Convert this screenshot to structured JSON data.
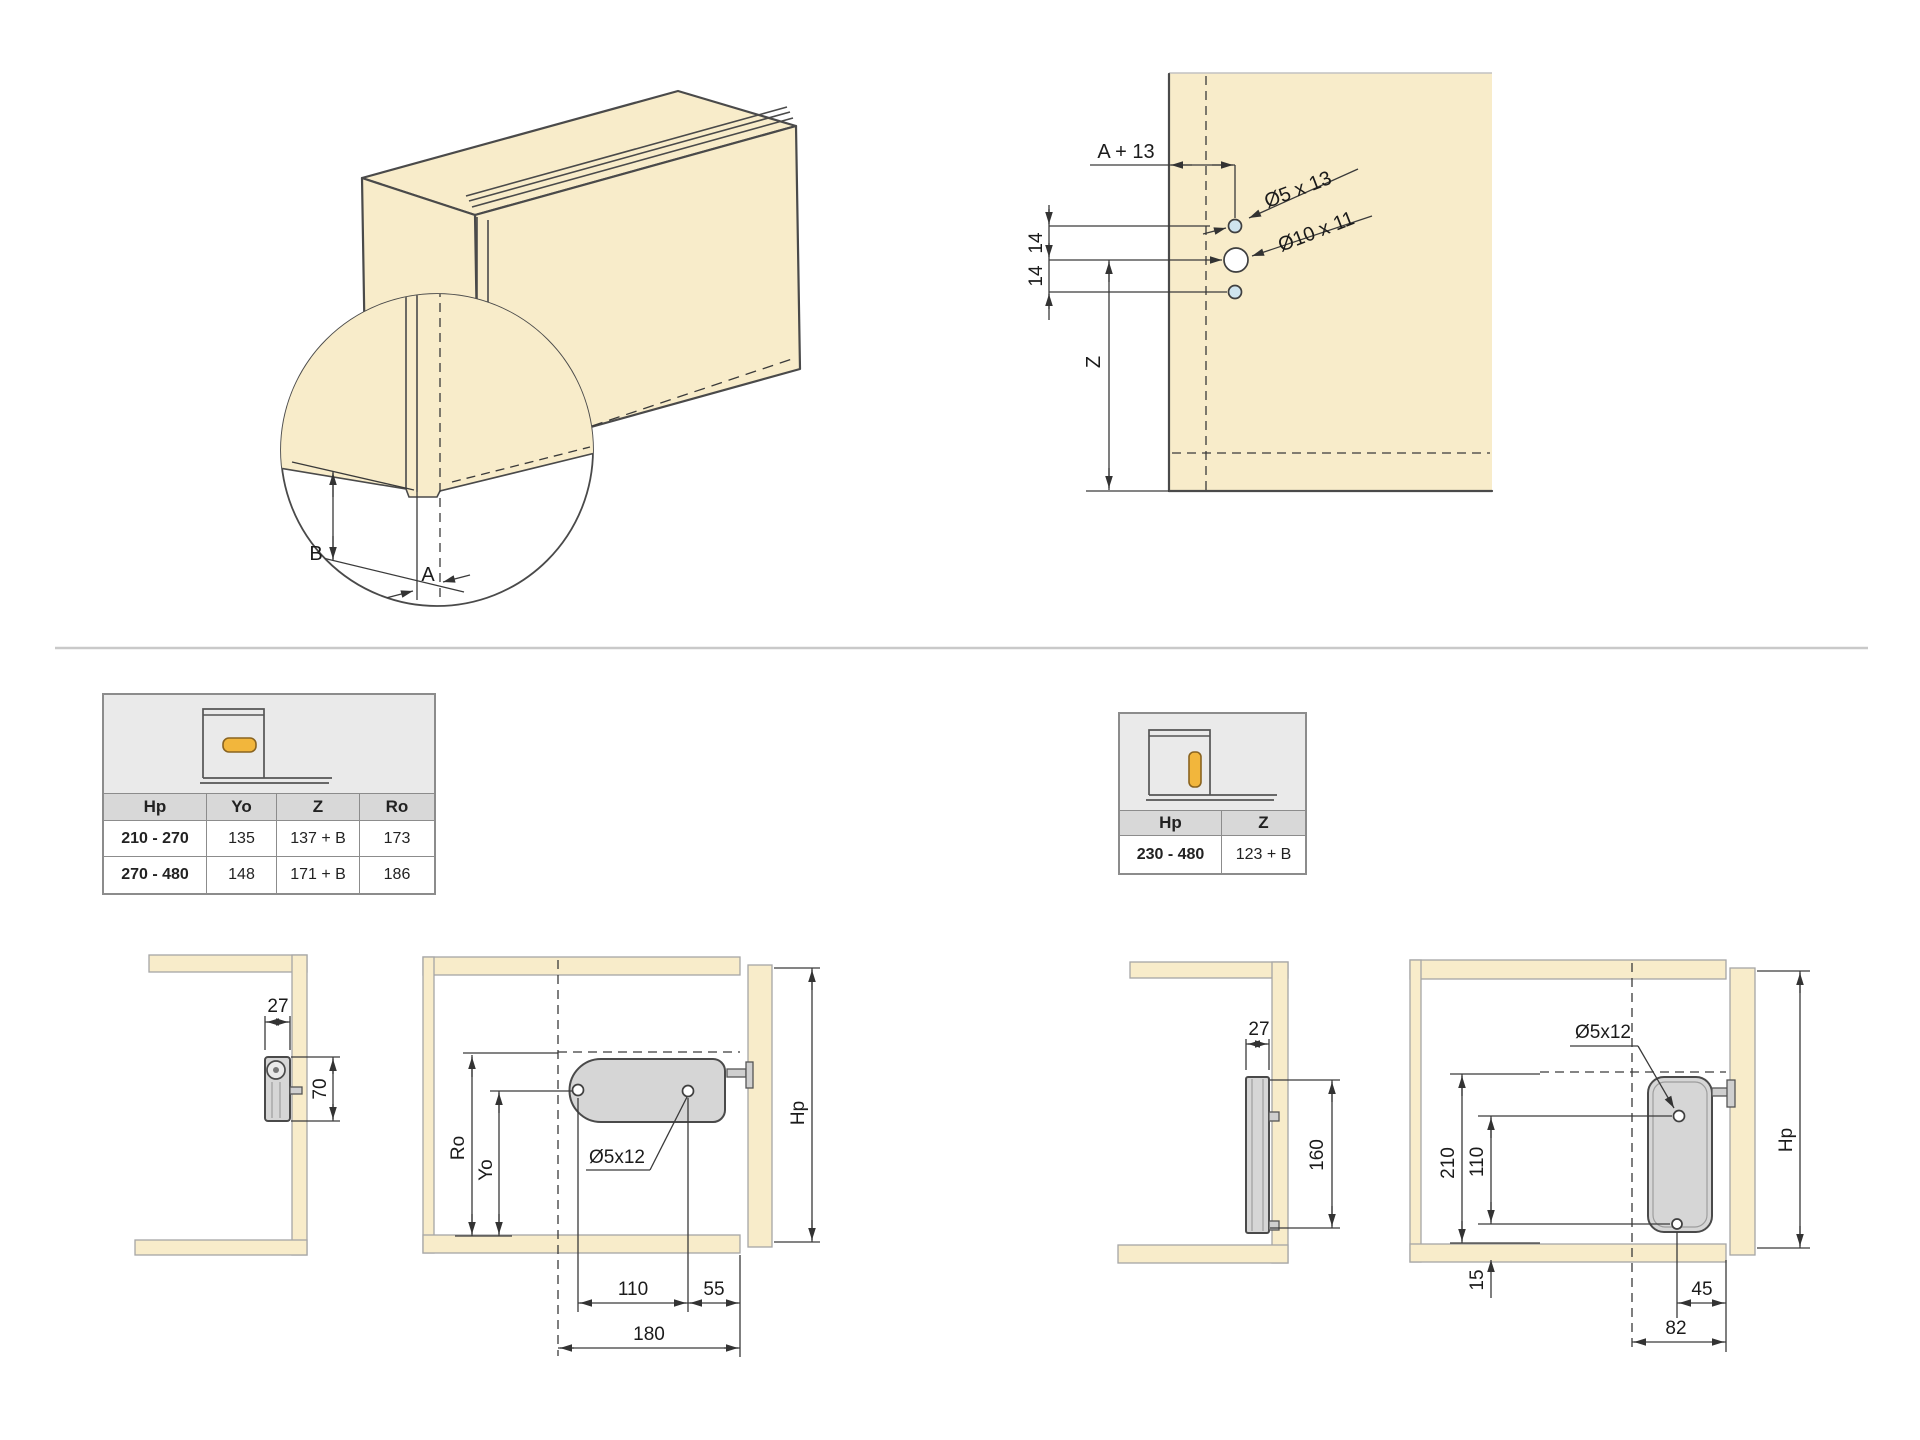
{
  "colors": {
    "tan": "#f8ecca",
    "hardware": "#d6d6d6",
    "accent": "#f2b63c",
    "hole": "#cfe4ef",
    "line": "#4a4a4a",
    "divider": "#c9c9c9"
  },
  "iso_detail": {
    "dim_b": "B",
    "dim_a": "A"
  },
  "drill": {
    "a13": "A + 13",
    "hole_small": "Ø5 x 13",
    "hole_big": "Ø10 x 11",
    "s14a": "14",
    "s14b": "14",
    "z": "Z"
  },
  "tables": {
    "left": {
      "headers": [
        "Hp",
        "Yo",
        "Z",
        "Ro"
      ],
      "rows": [
        [
          "210 - 270",
          "135",
          "137 + B",
          "173"
        ],
        [
          "270 - 480",
          "148",
          "171 + B",
          "186"
        ]
      ]
    },
    "right": {
      "headers": [
        "Hp",
        "Z"
      ],
      "rows": [
        [
          "230 - 480",
          "123 + B"
        ]
      ]
    }
  },
  "left_side_view": {
    "w27": "27",
    "h70": "70"
  },
  "left_front_view": {
    "ro": "Ro",
    "yo": "Yo",
    "hole": "Ø5x12",
    "d110": "110",
    "d55": "55",
    "d180": "180",
    "hp": "Hp"
  },
  "right_side_view": {
    "w27": "27",
    "h160": "160"
  },
  "right_front_view": {
    "hole": "Ø5x12",
    "d210": "210",
    "d110": "110",
    "d15": "15",
    "d45": "45",
    "d82": "82",
    "hp": "Hp"
  }
}
